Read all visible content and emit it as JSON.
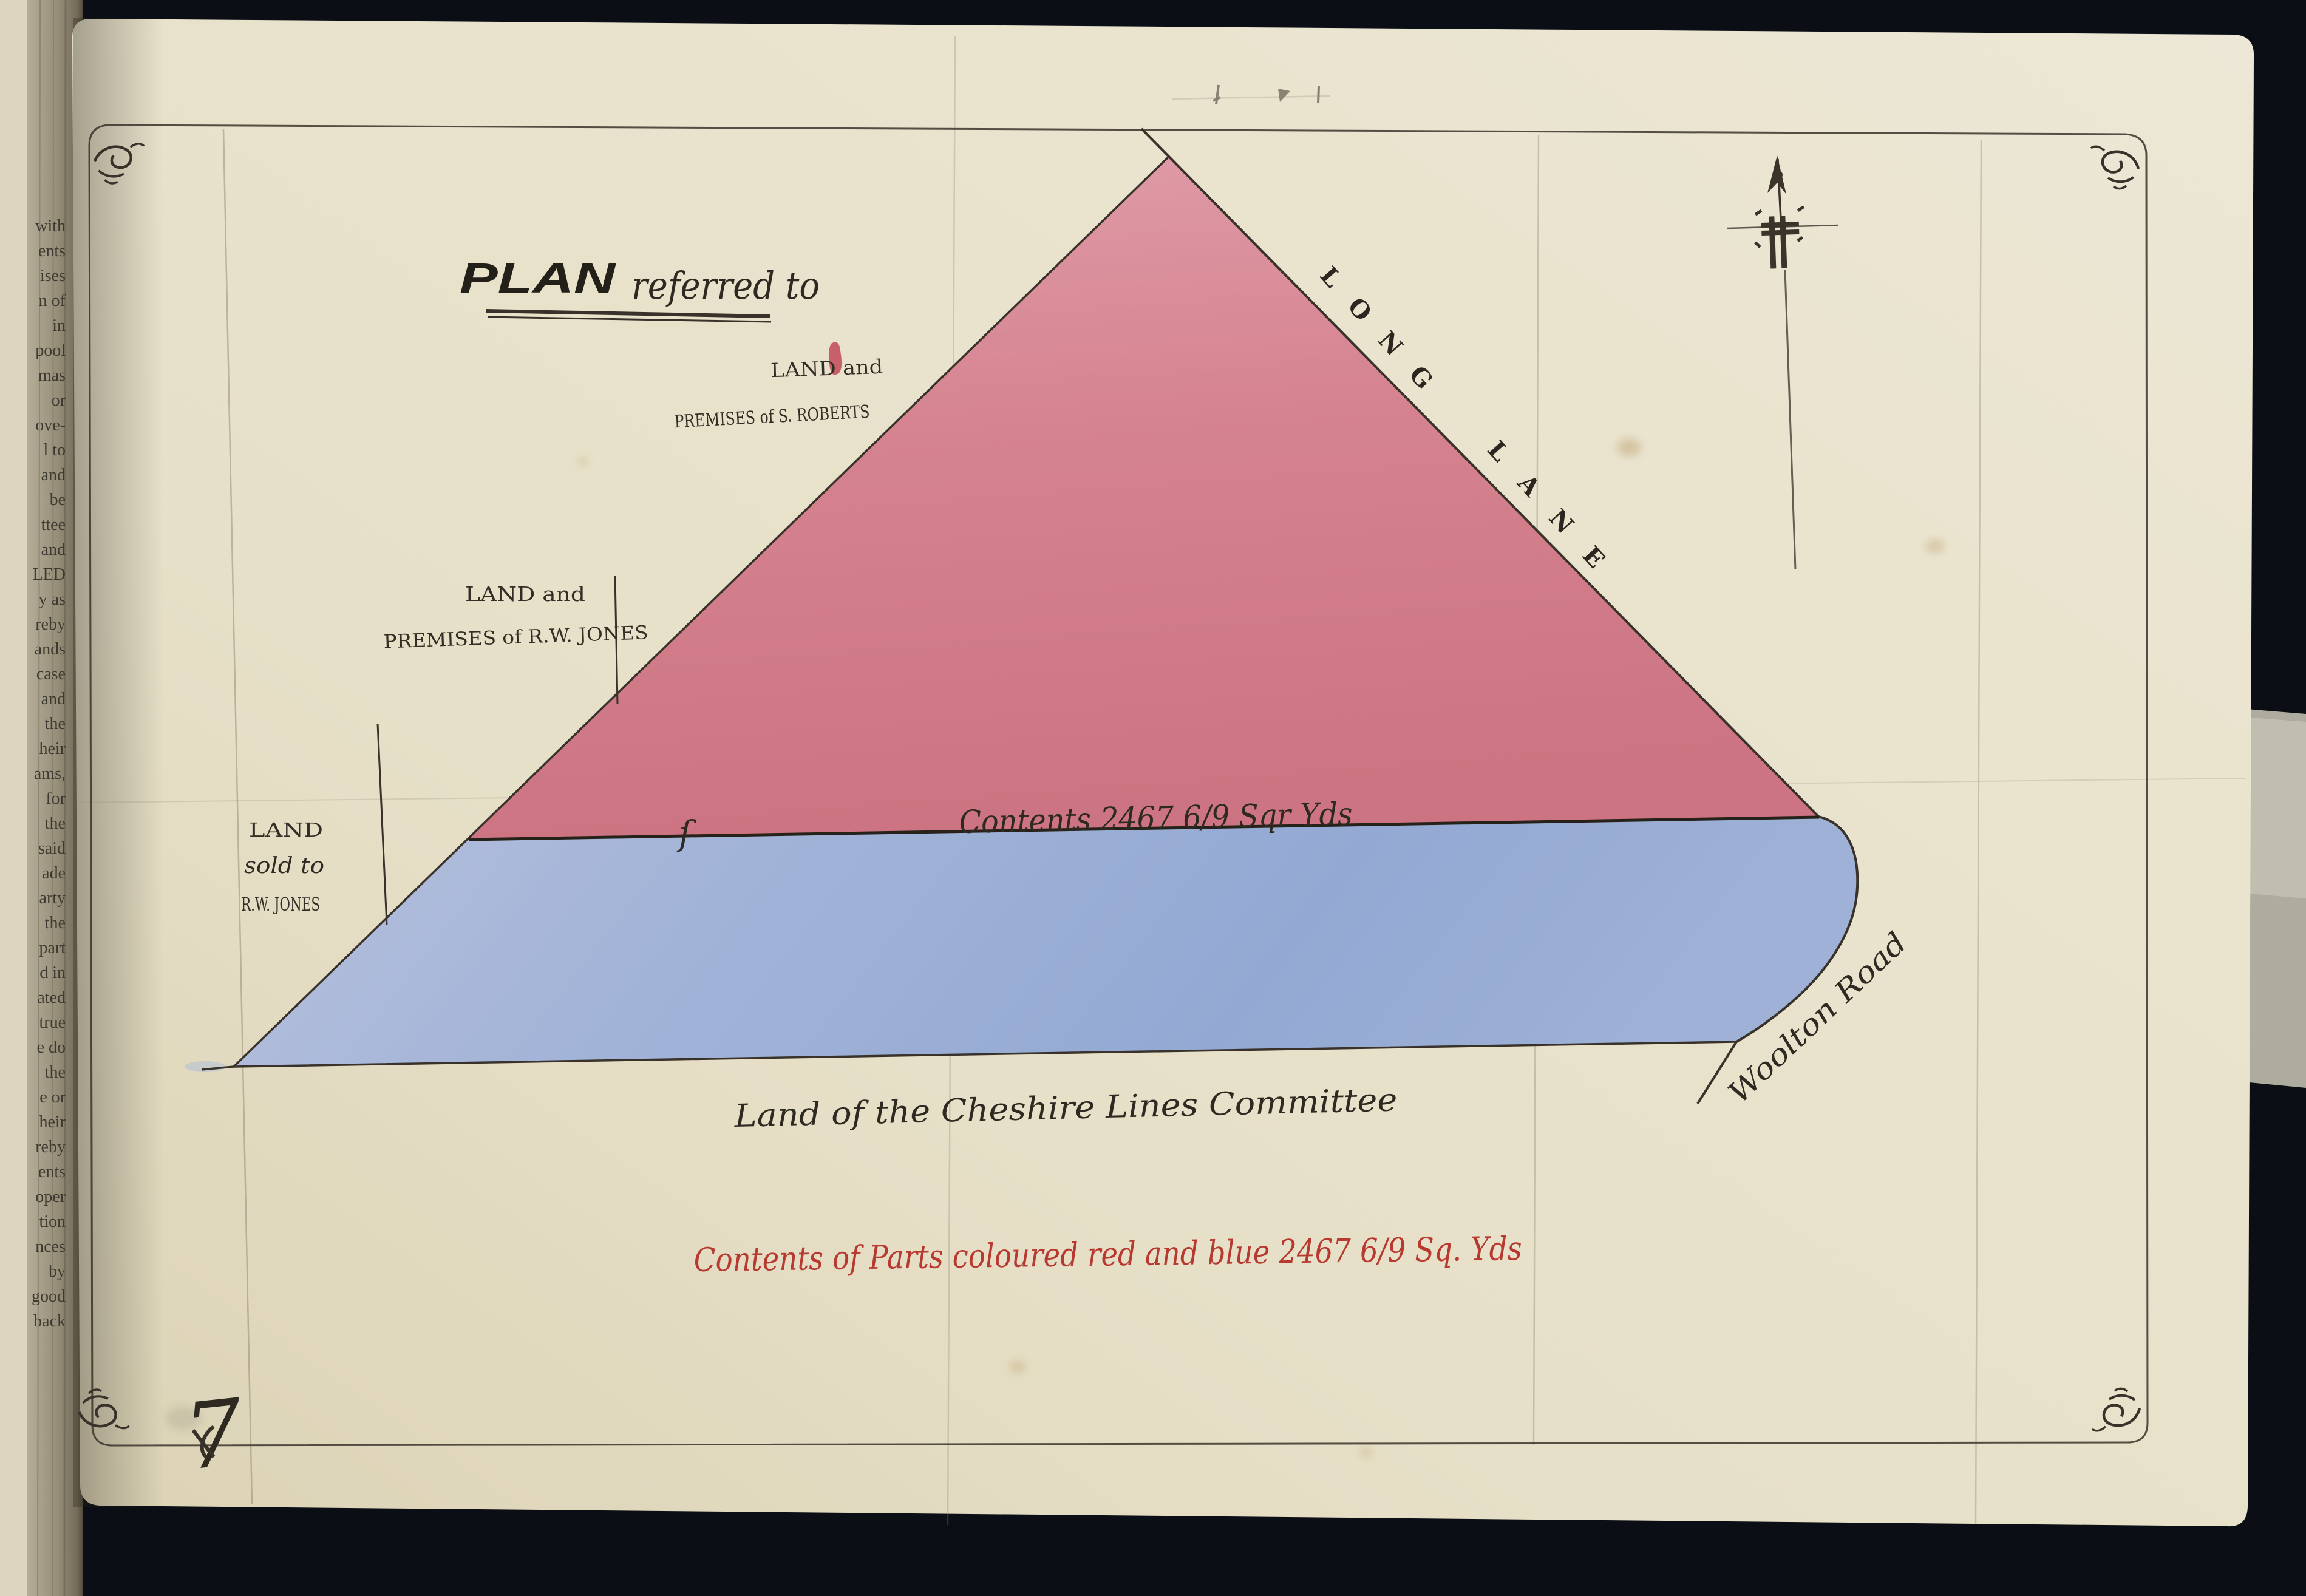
{
  "colors": {
    "photo_background": "#0b0e14",
    "paper": "#e9e2cb",
    "red_parcel": "#d5838f",
    "blue_parcel": "#9db1d9",
    "ink": "#38322a",
    "red_ink": "#b7392f"
  },
  "left_page": {
    "fragments": [
      "with",
      "ents",
      "ises",
      "n of",
      "in",
      "pool",
      "mas",
      "or",
      "ove-",
      "l to",
      "and",
      "be",
      "ttee",
      "and",
      "LED",
      "y as",
      "reby",
      "ands",
      "case",
      "and",
      "the",
      "heir",
      "ams,",
      "for",
      "the",
      "said",
      "ade",
      "arty",
      "the",
      "part",
      "d in",
      "ated",
      "true",
      "e do",
      "the",
      "e or",
      "heir",
      "reby",
      "ents",
      "oper",
      "tion",
      "nces",
      "by",
      "good",
      "back"
    ]
  },
  "plan": {
    "title_main": "PLAN",
    "title_script": "referred to",
    "roberts_line1": "LAND and",
    "roberts_line2": "PREMISES of S. ROBERTS",
    "jones_premises_line1": "LAND and",
    "jones_premises_line2": "PREMISES of R.W. JONES",
    "jones_sold_line1": "LAND",
    "jones_sold_line2": "sold to",
    "jones_sold_line3": "R.W. JONES",
    "long_lane_word1": "LONG",
    "long_lane_word2": "LANE",
    "woolton_road": "Woolton Road",
    "cheshire_committee": "Land of the Cheshire Lines Committee",
    "s_mark": "ſ",
    "contents_boundary": "Contents 2467 6/9 Sqr Yds",
    "red_note": "Contents of Parts coloured red and blue 2467 6/9 Sq. Yds",
    "bottom_left_mark": "7"
  }
}
